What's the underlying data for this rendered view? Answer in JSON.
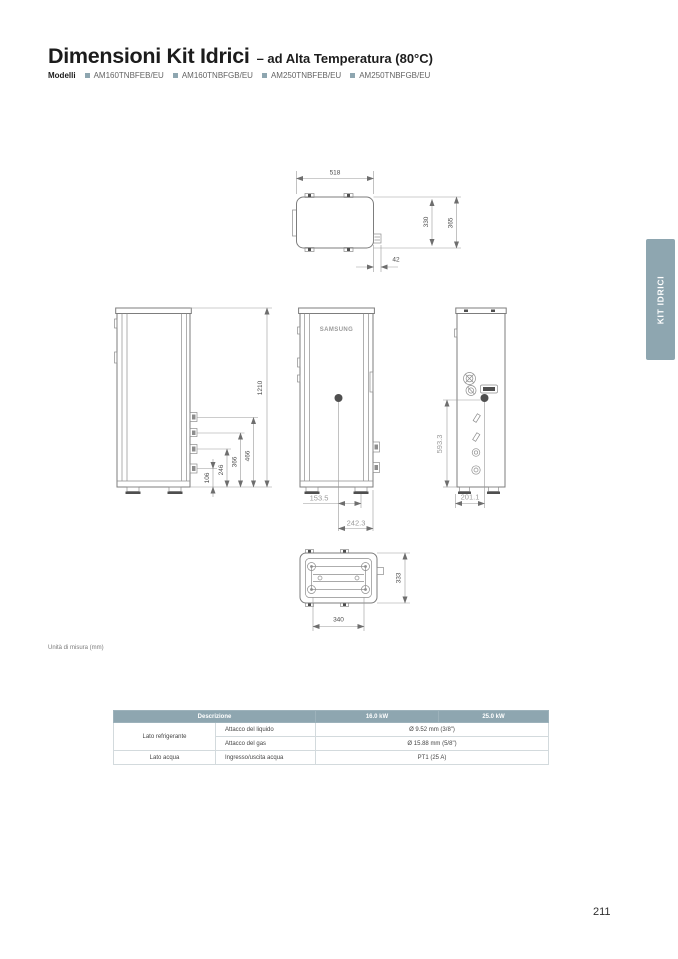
{
  "page": {
    "title": "Dimensioni Kit Idrici",
    "subtitle": "– ad Alta Temperatura (80°C)",
    "models_label": "Modelli",
    "models": [
      "AM160TNBFEB/EU",
      "AM160TNBFGB/EU",
      "AM250TNBFEB/EU",
      "AM250TNBFGB/EU"
    ],
    "units_note": "Unità di misura (mm)",
    "side_tab": "KIT IDRICI",
    "page_number": "211"
  },
  "colors": {
    "accent": "#8ea6b0",
    "title_text": "#1c1c1c",
    "body_text": "#454545",
    "drawing_line": "#8d8d8d"
  },
  "drawing": {
    "brand": "SAMSUNG",
    "top_view": {
      "width": "518",
      "depth_inner": "330",
      "depth_outer": "365",
      "offset": "42"
    },
    "side_view": {
      "height": "1210",
      "pipe1": "106",
      "pipe2": "246",
      "pipe3": "366",
      "pipe4": "466"
    },
    "front_view": {
      "offset1": "153.5",
      "offset2": "242.3"
    },
    "rear_view": {
      "height": "593.3",
      "offset": "201.1"
    },
    "bottom_view": {
      "depth": "333",
      "foot_span": "340"
    }
  },
  "table": {
    "headers": {
      "description": "Descrizione",
      "kw16": "16.0 kW",
      "kw25": "25.0 kW"
    },
    "rows": [
      {
        "group": "Lato refrigerante",
        "item": "Attacco del liquido",
        "value": "Ø 9.52 mm (3/8\")"
      },
      {
        "group": "",
        "item": "Attacco del gas",
        "value": "Ø 15.88 mm (5/8\")"
      },
      {
        "group": "Lato acqua",
        "item": "Ingresso/uscita acqua",
        "value": "PT1 (25 A)"
      }
    ]
  }
}
